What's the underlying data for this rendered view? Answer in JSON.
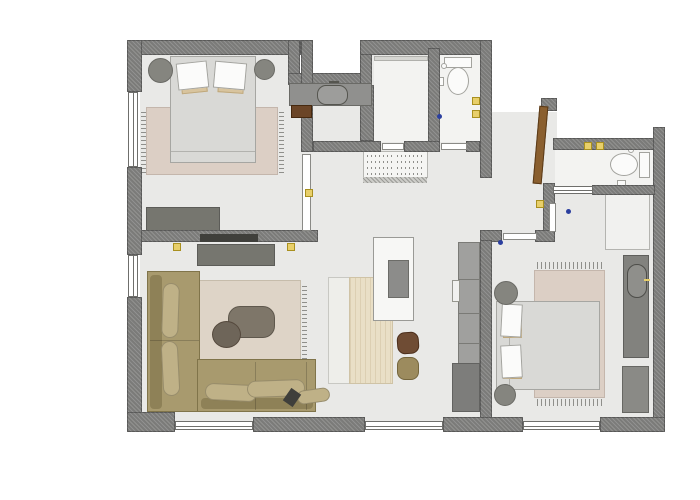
{
  "document": {
    "type": "apartment-floor-plan",
    "visible_text": []
  },
  "palette": {
    "wall": "#7b7b79",
    "floor": "#e9e9e7",
    "floor-bath": "#f3f3f1",
    "linen": "#d9d9d6",
    "rug-pink": "#dccfc5",
    "rug-beige": "#ded4c7",
    "tan": "#d8c49e",
    "sofa": "#a89a6e",
    "sofa-dark": "#8e8157",
    "sofa-light": "#bfb187",
    "wood": "#e9dfc6",
    "wood-stripe": "#dccfb2",
    "chair-brown": "#6f4c34",
    "chair-olive": "#9c8b5e",
    "gray-furn": "#76766f",
    "door-wood": "#8a5f2f",
    "socket": "#e8cf6a",
    "socket-edge": "#a9901f",
    "blue": "#2b3f9f",
    "tv": "#3f3f3b",
    "white-furn": "#fbfbfa"
  },
  "rooms": [
    {
      "name": "bedroom-top-left",
      "furniture": [
        "double-bed",
        "pillow",
        "pillow",
        "nightstand",
        "nightstand",
        "area-rug",
        "dresser",
        "wall-tv"
      ]
    },
    {
      "name": "hallway",
      "furniture": [
        "washbasin-counter",
        "stool",
        "built-in-wardrobe"
      ]
    },
    {
      "name": "wc",
      "furniture": [
        "toilet",
        "paper-holder"
      ]
    },
    {
      "name": "storage-room",
      "furniture": [
        "shelf"
      ]
    },
    {
      "name": "living-room",
      "furniture": [
        "corner-sofa",
        "coffee-table",
        "pouf",
        "area-rug",
        "tv-sideboard",
        "floor-lamp"
      ]
    },
    {
      "name": "kitchen-dining",
      "furniture": [
        "dining-table",
        "bench",
        "island-with-sink",
        "chair",
        "chair",
        "tall-cabinets"
      ]
    },
    {
      "name": "entry",
      "furniture": [
        "entry-door"
      ]
    },
    {
      "name": "bathroom",
      "furniture": [
        "toilet",
        "paper-holder"
      ]
    },
    {
      "name": "bedroom-bottom-right",
      "furniture": [
        "double-bed",
        "pillow",
        "pillow",
        "nightstand",
        "nightstand",
        "area-rug",
        "wardrobe",
        "vanity-unit",
        "corner-closet"
      ]
    }
  ],
  "openings": {
    "windows": 5,
    "interior_doors": 6,
    "entry_doors": 1
  }
}
